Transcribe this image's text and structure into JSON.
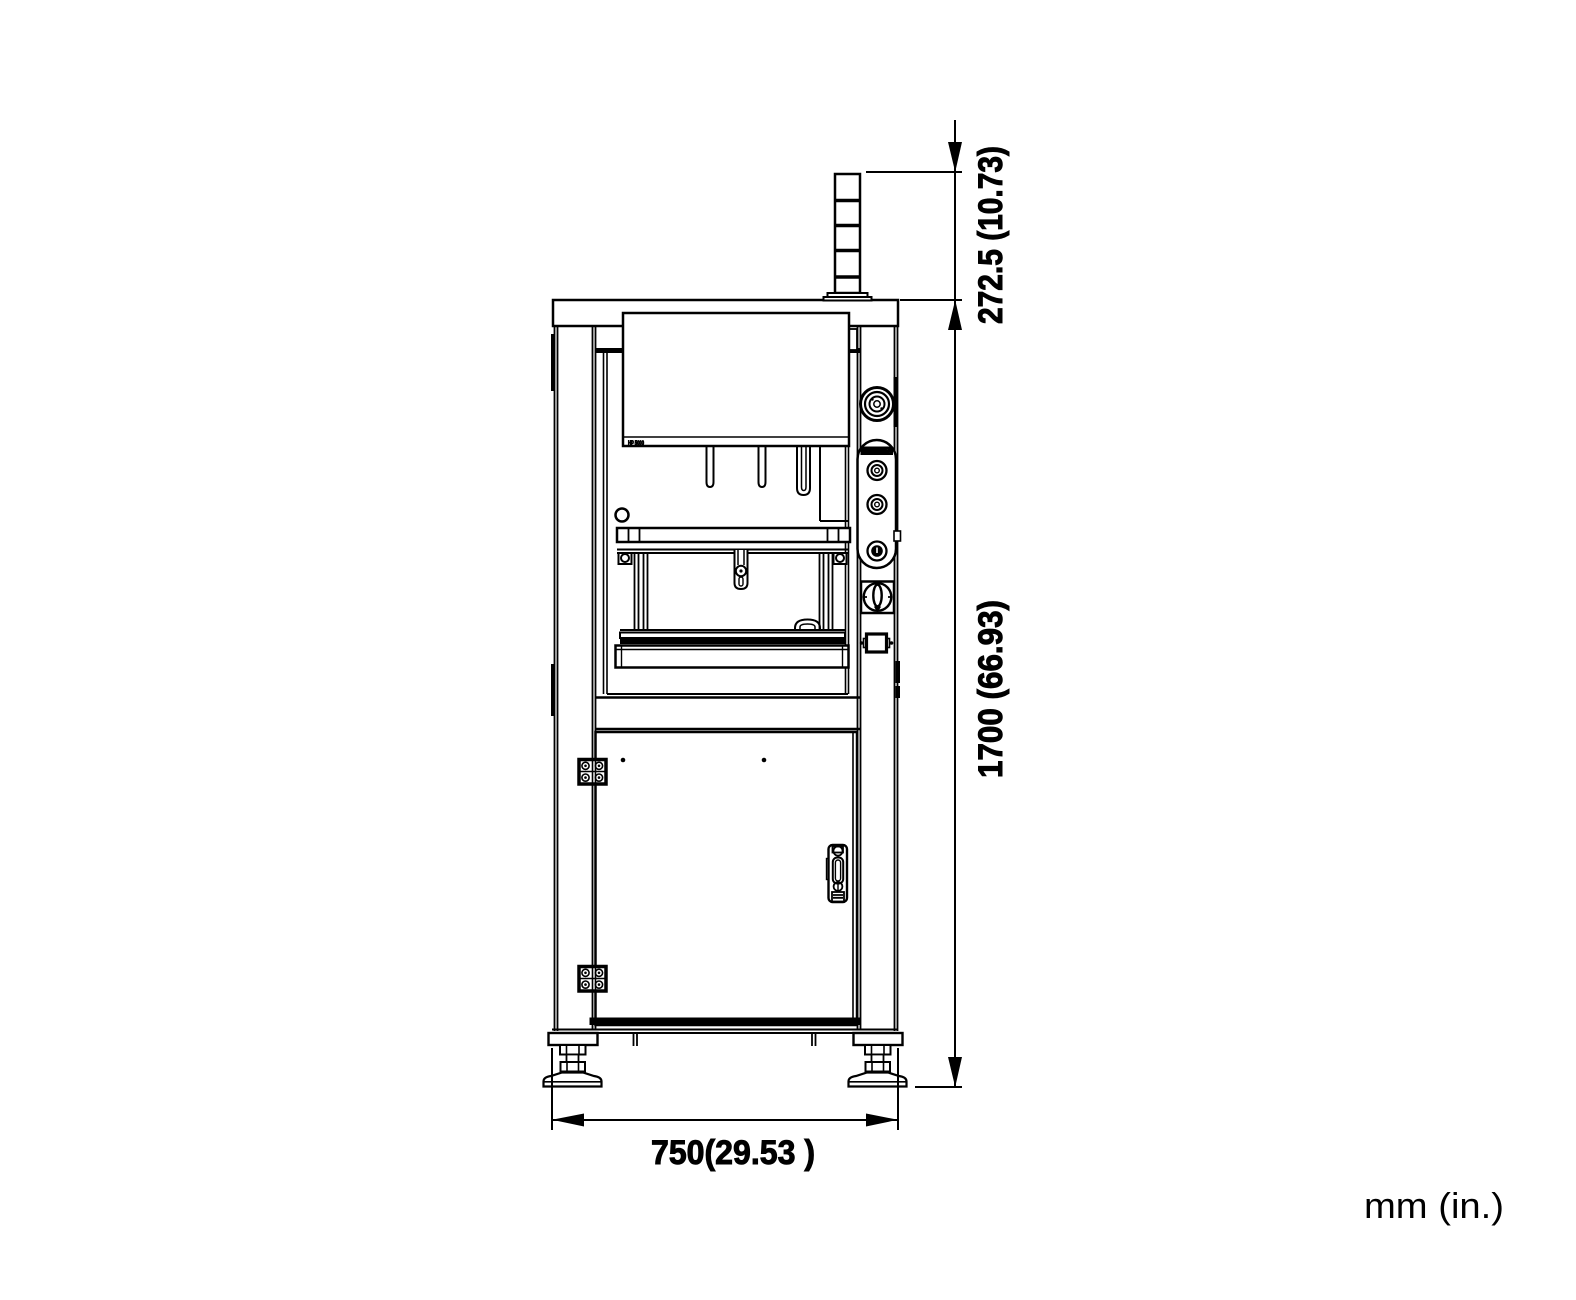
{
  "diagram": {
    "title": "machine-front-view-dimension-drawing",
    "units_note": "mm (in.)",
    "dimensions": {
      "top_height": "272.5 (10.73)",
      "total_height": "1700 (66.93)",
      "width": "750(29.53 )"
    },
    "labels": {
      "panel_label": "HP 5000",
      "control_panel_label": "CAUTION"
    },
    "colors": {
      "line": "#000000",
      "background": "#ffffff"
    }
  }
}
